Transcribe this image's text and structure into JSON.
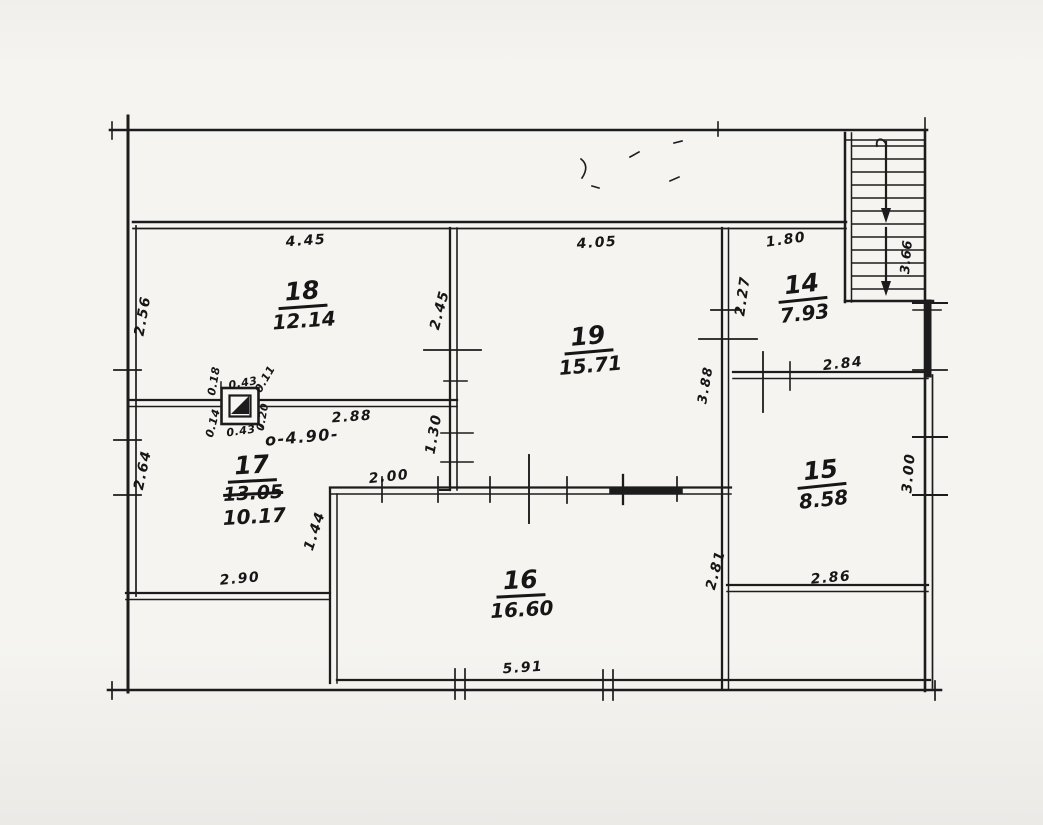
{
  "plan": {
    "rooms": {
      "r14": {
        "number": "14",
        "area": "7.93"
      },
      "r15": {
        "number": "15",
        "area": "8.58"
      },
      "r16": {
        "number": "16",
        "area": "16.60"
      },
      "r17": {
        "number": "17",
        "area_crossed": "13.05",
        "area": "10.17"
      },
      "r18": {
        "number": "18",
        "area": "12.14"
      },
      "r19": {
        "number": "19",
        "area": "15.71"
      }
    },
    "dims": {
      "top18": "4.45",
      "left18": "2.56",
      "right18": "2.45",
      "top19": "4.05",
      "mid19_17": "1.30",
      "top14": "1.80",
      "left14": "2.27",
      "stairs_run": "3.66",
      "top15": "2.84",
      "left15col": "3.88",
      "right15": "3.00",
      "bottom15": "2.86",
      "right16": "2.81",
      "topleft16": "2.00",
      "step16": "1.44",
      "bottom16": "5.91",
      "left17": "2.64",
      "bottom17": "2.90",
      "wall17": "2.88",
      "overall17": "o-4.90-",
      "chimney_top": "0.43",
      "chimney_bottom": "0.43",
      "chimney_left_top": "0.18",
      "chimney_left_bottom": "0.14",
      "chimney_right_top": "0.11",
      "chimney_right_bottom": "0.20"
    }
  }
}
